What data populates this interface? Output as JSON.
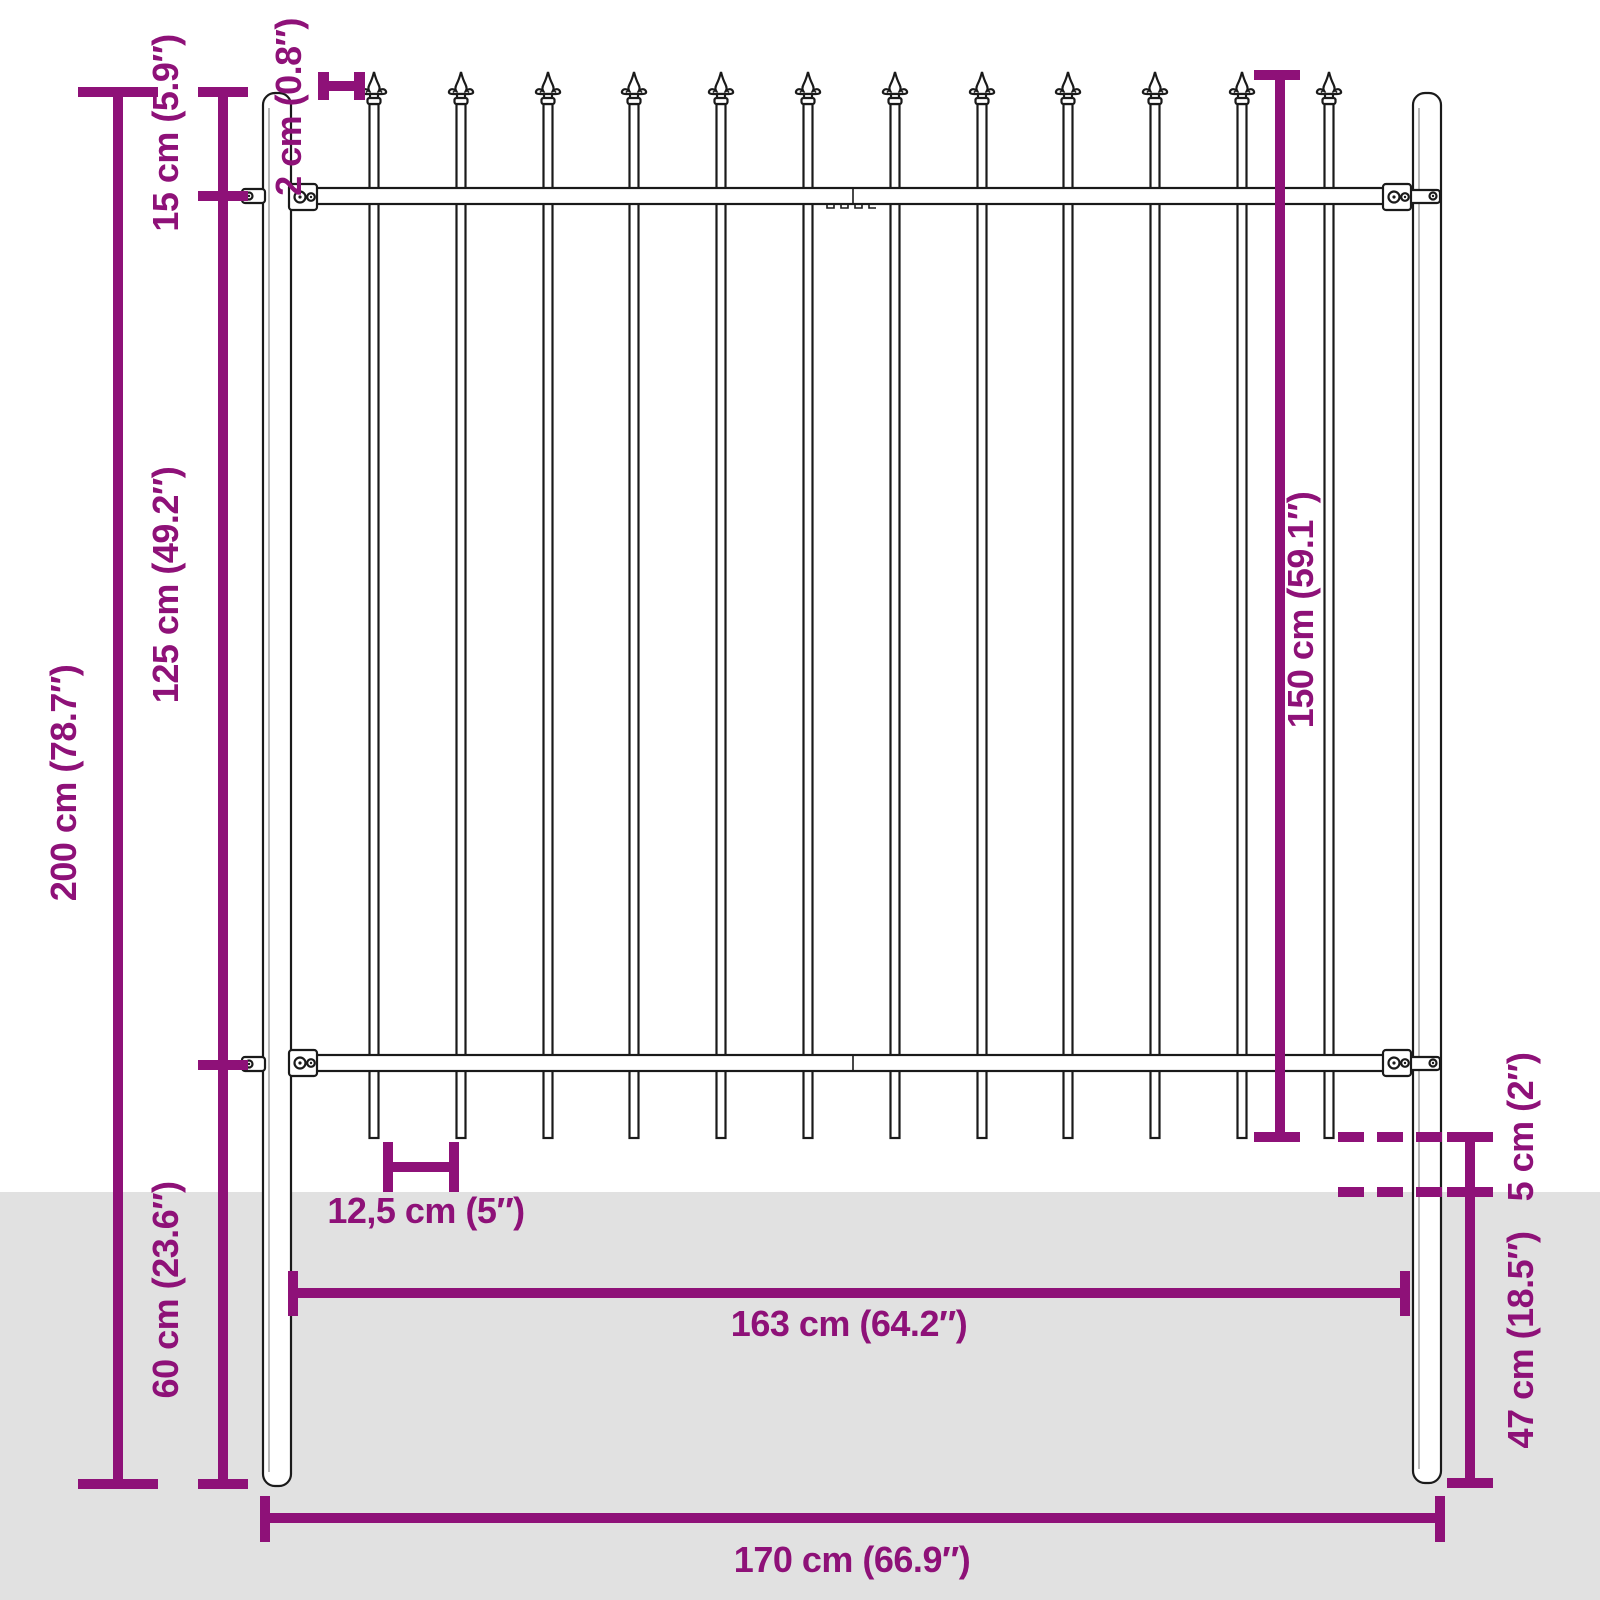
{
  "diagram": {
    "description": "Technical dimension diagram of a steel garden fence panel with spear-top pickets and two round ground posts, lower part buried below ground level",
    "picket_count": 12,
    "colors": {
      "dimension": "#8e1178",
      "outline": "#1a1a1a",
      "ground": "#e1e1e1",
      "background": "#ffffff"
    },
    "dimensions": {
      "total_height": "200 cm (78.7″)",
      "spear_section_height": "15 cm (5.9″)",
      "rail_to_rail_height": "125 cm (49.2″)",
      "post_depth_total": "60 cm (23.6″)",
      "picket_width": "2 cm (0.8″)",
      "panel_height": "150 cm (59.1″)",
      "ground_clearance": "5 cm (2″)",
      "post_underground_depth": "47 cm (18.5″)",
      "picket_spacing": "12,5 cm (5″)",
      "panel_width": "163 cm (64.2″)",
      "total_width": "170 cm (66.9″)"
    }
  }
}
